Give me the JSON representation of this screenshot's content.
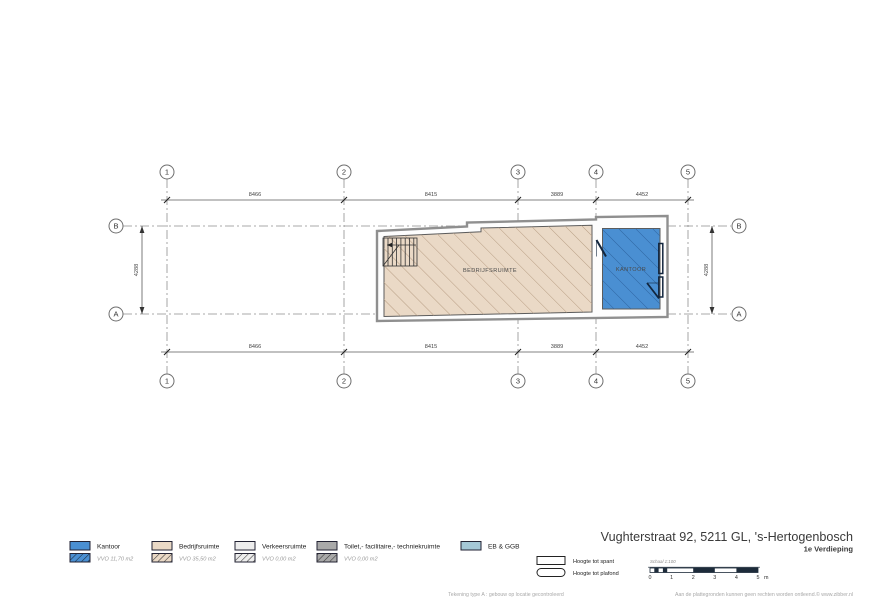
{
  "colors": {
    "kantoor_blue": "#4a8fd2",
    "kantoor_hatch": "#2f66a3",
    "bedrijf_tan": "#ead9c6",
    "bedrijf_hatch": "#b79d83",
    "verkeers_gray": "#ededed",
    "toilet_gray": "#a9a9a9",
    "ebggb_blue": "#a5c8d7"
  },
  "plan": {
    "grid_columns": [
      "1",
      "2",
      "3",
      "4",
      "5"
    ],
    "grid_rows": [
      "B",
      "A"
    ],
    "dims_horizontal": [
      "8466",
      "8415",
      "3889",
      "4452"
    ],
    "dim_vertical": "4288",
    "rooms": [
      {
        "name": "BEDRIJFSRUIMTE"
      },
      {
        "name": "KANTOOR"
      }
    ]
  },
  "legend": {
    "items": [
      {
        "label": "Kantoor",
        "vvo": "VVO 11,70 m2"
      },
      {
        "label": "Bedrijfsruimte",
        "vvo": "VVO 35,50 m2"
      },
      {
        "label": "Verkeersruimte",
        "vvo": "VVO 0,00 m2"
      },
      {
        "label": "Toilet,- facilitaire,- techniekruimte",
        "vvo": "VVO 0,00 m2"
      },
      {
        "label": "EB & GGB",
        "vvo": ""
      }
    ],
    "height_items": [
      {
        "label": "Hoogte tot spant"
      },
      {
        "label": "Hoogte tot plafond"
      }
    ]
  },
  "titleblock": {
    "address": "Vughterstraat 92, 5211 GL, 's-Hertogenbosch",
    "floor": "1e Verdieping",
    "scale_label": "Schaal 1:100",
    "scale_ticks": [
      "0",
      "1",
      "2",
      "3",
      "4",
      "5"
    ],
    "scale_unit": "m"
  },
  "footer": {
    "center": "Tekening type A : gebouw op locatie gecontroleerd",
    "right": "Aan de plattegronden kunnen geen rechten worden ontleend.© www.zibber.nl"
  }
}
